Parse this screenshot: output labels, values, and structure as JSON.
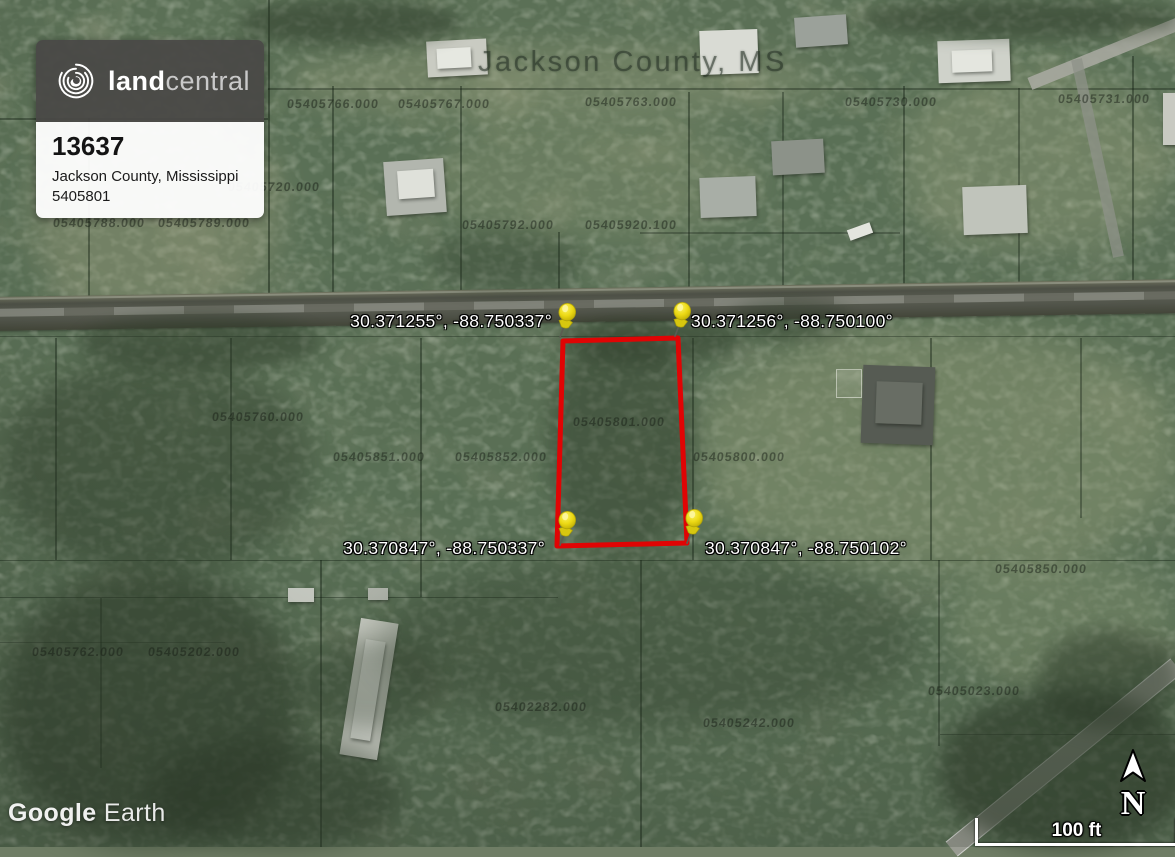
{
  "brand_card": {
    "brand_bold": "land",
    "brand_light": "central",
    "listing_id": "13637",
    "location": "Jackson County, Mississippi",
    "parcel_number": "5405801"
  },
  "map": {
    "county_label": "Jackson County, MS",
    "watermark_word1": "Google",
    "watermark_word2": "Earth"
  },
  "coordinates": {
    "top_left": "30.371255°, -88.750337°",
    "top_right": "30.371256°, -88.750100°",
    "bottom_left": "30.370847°, -88.750337°",
    "bottom_right": "30.370847°, -88.750102°"
  },
  "scale_bar": {
    "label": "100 ft"
  },
  "compass": {
    "label": "N"
  },
  "colors": {
    "boundary_red": "#e00404",
    "pin_yellow": "#f0dd1c",
    "card_header": "#494847"
  },
  "parcel_numbers": [
    {
      "text": "05405766.000",
      "x": 287,
      "y": 97
    },
    {
      "text": "05405767.000",
      "x": 398,
      "y": 97
    },
    {
      "text": "05405763.000",
      "x": 585,
      "y": 95
    },
    {
      "text": "05405730.000",
      "x": 845,
      "y": 95
    },
    {
      "text": "05405731.000",
      "x": 1058,
      "y": 92
    },
    {
      "text": "05405720.000",
      "x": 228,
      "y": 180
    },
    {
      "text": "05405788.000",
      "x": 53,
      "y": 216
    },
    {
      "text": "05405789.000",
      "x": 158,
      "y": 216
    },
    {
      "text": "05405792.000",
      "x": 462,
      "y": 218
    },
    {
      "text": "05405920.100",
      "x": 585,
      "y": 218
    },
    {
      "text": "05405760.000",
      "x": 212,
      "y": 410
    },
    {
      "text": "05405851.000",
      "x": 333,
      "y": 450
    },
    {
      "text": "05405852.000",
      "x": 455,
      "y": 450
    },
    {
      "text": "05405801.000",
      "x": 573,
      "y": 415
    },
    {
      "text": "05405800.000",
      "x": 693,
      "y": 450
    },
    {
      "text": "05405850.000",
      "x": 995,
      "y": 562
    },
    {
      "text": "05405762.000",
      "x": 32,
      "y": 645
    },
    {
      "text": "05405202.000",
      "x": 148,
      "y": 645
    },
    {
      "text": "05402282.000",
      "x": 495,
      "y": 700
    },
    {
      "text": "05405242.000",
      "x": 703,
      "y": 716
    },
    {
      "text": "05405023.000",
      "x": 928,
      "y": 684
    }
  ]
}
